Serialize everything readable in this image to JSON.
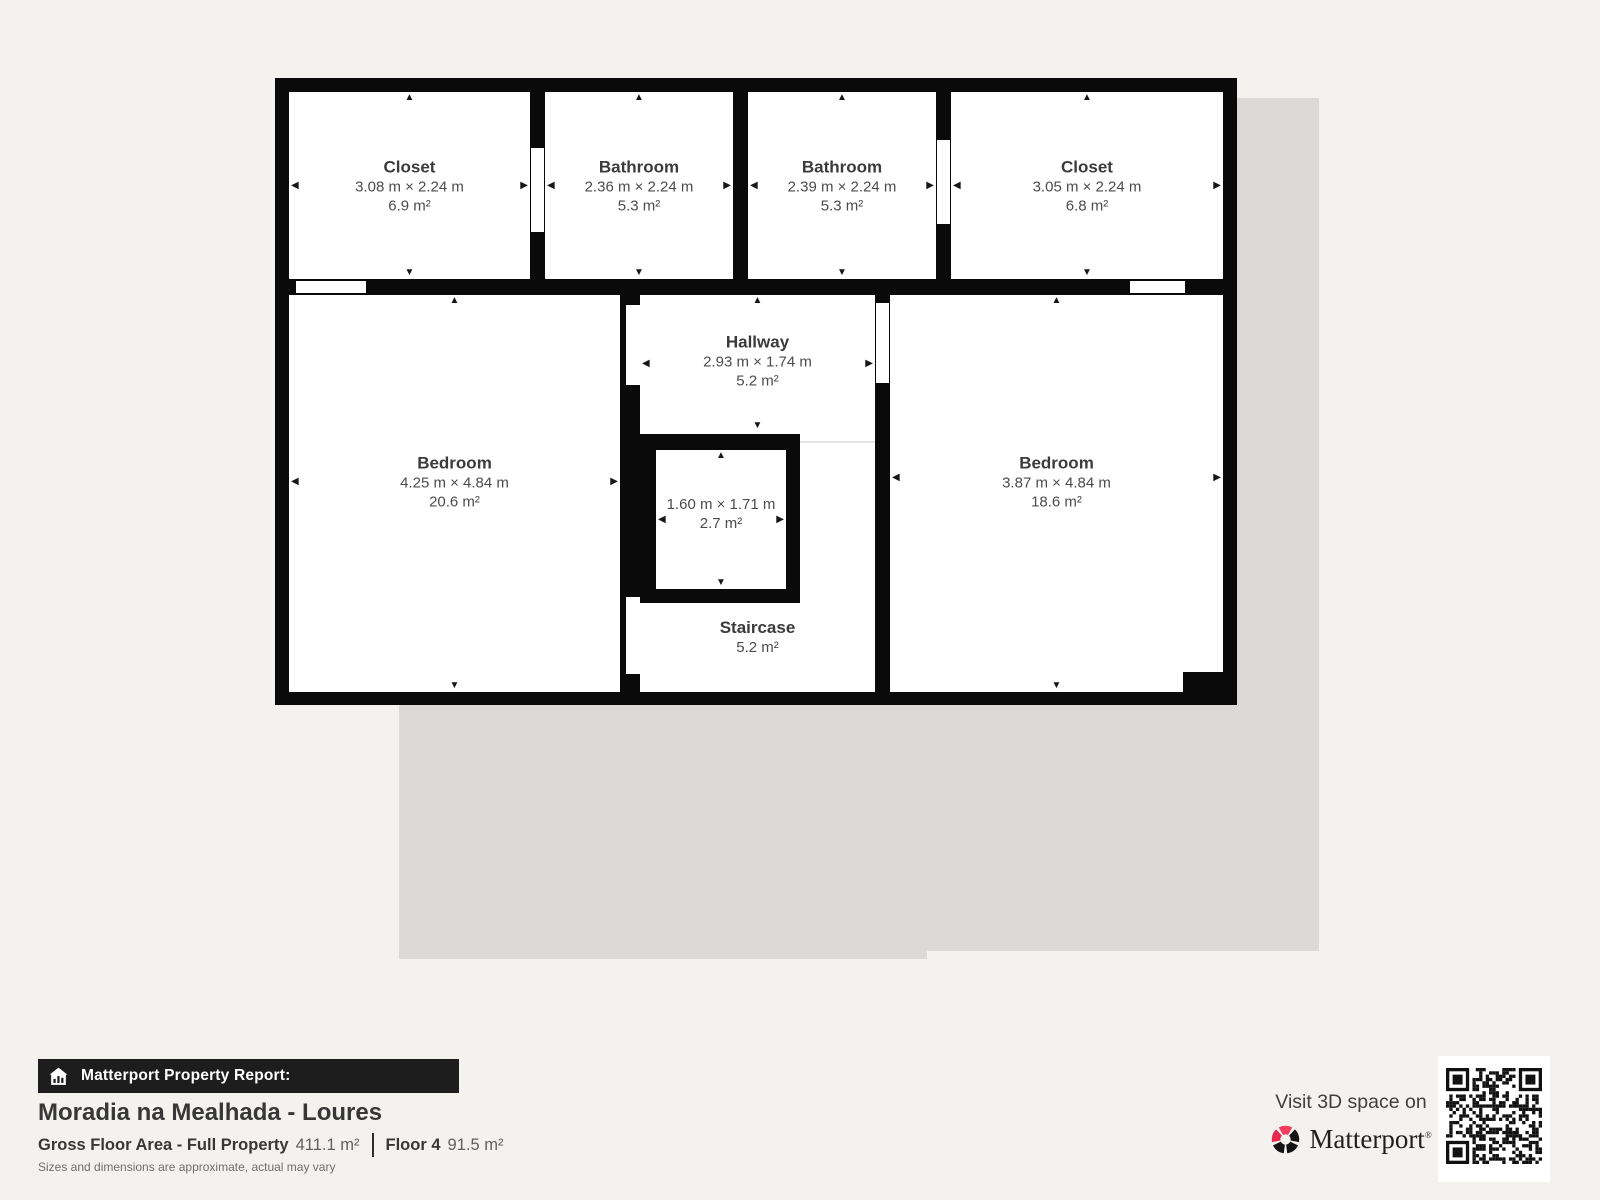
{
  "floorplan": {
    "rooms": [
      {
        "id": "closet-1",
        "name": "Closet",
        "dims": "3.08 m × 2.24 m",
        "area": "6.9 m²"
      },
      {
        "id": "bathroom-1",
        "name": "Bathroom",
        "dims": "2.36 m × 2.24 m",
        "area": "5.3 m²"
      },
      {
        "id": "bathroom-2",
        "name": "Bathroom",
        "dims": "2.39 m × 2.24 m",
        "area": "5.3 m²"
      },
      {
        "id": "closet-2",
        "name": "Closet",
        "dims": "3.05 m × 2.24 m",
        "area": "6.8 m²"
      },
      {
        "id": "bedroom-left",
        "name": "Bedroom",
        "dims": "4.25 m × 4.84 m",
        "area": "20.6 m²"
      },
      {
        "id": "hallway",
        "name": "Hallway",
        "dims": "2.93 m × 1.74 m",
        "area": "5.2 m²"
      },
      {
        "id": "small-room",
        "name": "",
        "dims": "1.60 m × 1.71 m",
        "area": "2.7 m²"
      },
      {
        "id": "staircase",
        "name": "Staircase",
        "dims": "",
        "area": "5.2 m²"
      },
      {
        "id": "bedroom-right",
        "name": "Bedroom",
        "dims": "3.87 m × 4.84 m",
        "area": "18.6 m²"
      }
    ]
  },
  "report": {
    "banner_label": "Matterport Property Report:",
    "property_title": "Moradia na Mealhada - Loures",
    "gross_floor_label": "Gross Floor Area - Full Property",
    "gross_floor_value": "411.1 m²",
    "floor_label": "Floor 4",
    "floor_value": "91.5 m²",
    "disclaimer": "Sizes and dimensions are approximate, actual may vary"
  },
  "promo": {
    "visit_text": "Visit 3D space on",
    "brand": "Matterport",
    "trademark": "®"
  },
  "colors": {
    "wall": "#0a0a0a",
    "background": "#f3f2ef",
    "plan_shadow": "#dbdad8",
    "matterport_pink": "#f43c5f",
    "matterport_dark_pink": "#e8274b"
  }
}
